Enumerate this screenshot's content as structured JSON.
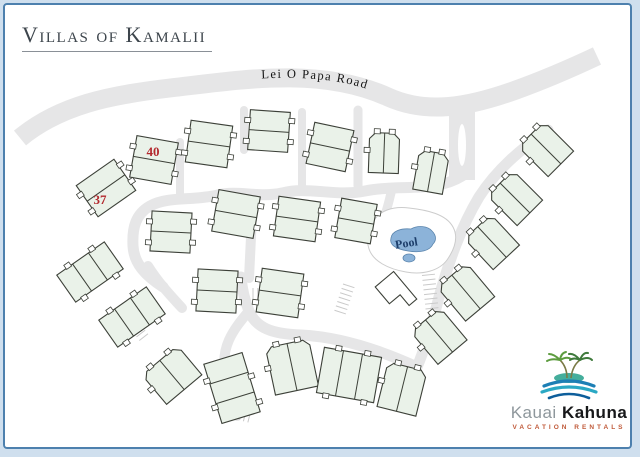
{
  "title": {
    "text": "Villas of Kamalii"
  },
  "logo": {
    "word1": "Kauai",
    "word2": "Kahuna",
    "tagline": "Vacation Rentals",
    "colors": {
      "word1": "#8e979c",
      "word2": "#17181a",
      "tagline": "#c05a3a",
      "palm": "#5d9c3f",
      "palm_dark": "#3f7a3c",
      "island": "#45ae9c",
      "wave1": "#1d7fb5",
      "wave2": "#2aa8c4",
      "wave3": "#0d5e9b"
    }
  },
  "frame": {
    "outer_band": "#cfdfee",
    "line": "#4d80ae",
    "background": "#ffffff"
  },
  "map": {
    "road_label": "Lei O Papa Road",
    "pool_label": "Pool",
    "unit_labels": [
      {
        "text": "40",
        "x": 153,
        "y": 156
      },
      {
        "text": "37",
        "x": 100,
        "y": 204
      }
    ],
    "colors": {
      "road": "#e6e6e7",
      "comb": "#c9c9c9",
      "building_fill": "#eaf2e9",
      "building_stroke": "#3c4038",
      "deck_stroke": "#cccccc",
      "pool_water": "#8cb3d9",
      "pool_stroke": "#5b85ad",
      "pool_text": "#1d3e6b",
      "label_red": "#b3282d",
      "road_text": "#151515"
    },
    "roads": {
      "main": "M 20,138 C 60,105 110,95 170,88 C 240,80 320,66 388,97 C 426,114 466,108 516,90 C 552,77 580,64 597,56",
      "main_width": 19,
      "entrance": {
        "d": "M 462,102 L 462,180",
        "width": 26,
        "median": {
          "cx": 462,
          "cy": 145,
          "rx": 4,
          "ry": 21
        }
      },
      "internal": [
        {
          "d": "M 462,176 C 435,193 400,184 365,191 C 335,197 308,186 282,193 C 258,198 238,190 218,195 C 193,201 168,196 150,206 C 136,214 132,227 133,246 C 134,264 146,276 163,287",
          "w": 11
        },
        {
          "d": "M 548,130 C 521,149 497,169 479,197 C 461,227 449,261 439,297 C 431,328 424,351 417,367",
          "w": 11
        },
        {
          "d": "M 417,367 C 382,351 341,337 301,335 C 272,334 256,328 249,311 C 244,299 242,288 241,277",
          "w": 11
        },
        {
          "d": "M 253,196 L 249,278",
          "w": 10
        },
        {
          "d": "M 249,311 C 233,330 219,348 226,377 C 230,396 234,408 237,416",
          "w": 10
        },
        {
          "d": "M 358,110 L 358,186",
          "w": 9
        },
        {
          "d": "M 302,112 L 302,188",
          "w": 8
        },
        {
          "d": "M 244,110 L 244,150",
          "w": 8
        },
        {
          "d": "M 180,142 L 180,198",
          "w": 8
        },
        {
          "d": "M 392,188 C 389,204 385,214 382,226",
          "w": 9
        },
        {
          "d": "M 148,266 C 158,282 170,295 182,308",
          "w": 10
        }
      ]
    },
    "parking": [
      {
        "x": 381,
        "y": 220,
        "rot": 0,
        "n": 8,
        "gap": 4.6,
        "len": 12,
        "dir": "h"
      },
      {
        "x": 421,
        "y": 266,
        "rot": -6,
        "n": 10,
        "gap": 4.8,
        "len": 13,
        "dir": "h"
      },
      {
        "x": 253,
        "y": 288,
        "rot": 0,
        "n": 7,
        "gap": 4.8,
        "len": 12,
        "dir": "v"
      },
      {
        "x": 224,
        "y": 404,
        "rot": 14,
        "n": 7,
        "gap": 4.6,
        "len": 12,
        "dir": "v"
      },
      {
        "x": 343,
        "y": 284,
        "rot": 18,
        "n": 7,
        "gap": 4.6,
        "len": 12,
        "dir": "h"
      },
      {
        "x": 128,
        "y": 326,
        "rot": -38,
        "n": 5,
        "gap": 4.6,
        "len": 11,
        "dir": "h"
      }
    ],
    "pool": {
      "deck_d": "M 372,224 C 378,210 394,206 409,208 C 427,210 446,214 453,227 C 459,238 454,250 447,260 C 439,271 422,275 406,272 C 388,269 373,261 369,249 C 366,240 368,231 372,224 Z",
      "water_d": "M 391,238 C 392,231 401,228 411,229 C 418,225 428,226 432,231 C 437,236 436,241 433,244 C 430,251 420,253 408,251 C 396,249 389,245 391,238 Z",
      "spa": {
        "cx": 409,
        "cy": 258,
        "rx": 6,
        "ry": 4
      },
      "label_x": 407,
      "label_y": 247,
      "label_rot": -9
    },
    "clubhouse": {
      "x": 396,
      "y": 293,
      "rot": -40,
      "d": "M -12,-18 L 12,-18 L 12,18 L 2,18 L 2,4 L -12,4 Z"
    },
    "buildings": [
      {
        "x": 154,
        "y": 160,
        "rot": 10,
        "t": "duplex",
        "w": 42,
        "h": 42
      },
      {
        "x": 106,
        "y": 188,
        "rot": -35,
        "t": "duplex",
        "w": 46,
        "h": 38
      },
      {
        "x": 209,
        "y": 144,
        "rot": 8,
        "t": "duplex",
        "w": 42,
        "h": 42
      },
      {
        "x": 269,
        "y": 131,
        "rot": 4,
        "t": "duplex",
        "w": 40,
        "h": 40
      },
      {
        "x": 330,
        "y": 147,
        "rot": 12,
        "t": "duplex",
        "w": 40,
        "h": 42
      },
      {
        "x": 384,
        "y": 153,
        "rot": 2,
        "t": "pair",
        "w": 30,
        "h": 40
      },
      {
        "x": 431,
        "y": 172,
        "rot": 10,
        "t": "pair",
        "w": 30,
        "h": 40
      },
      {
        "x": 171,
        "y": 232,
        "rot": 3,
        "t": "duplex",
        "w": 40,
        "h": 40
      },
      {
        "x": 236,
        "y": 214,
        "rot": 10,
        "t": "duplex",
        "w": 42,
        "h": 42
      },
      {
        "x": 297,
        "y": 219,
        "rot": 8,
        "t": "duplex",
        "w": 42,
        "h": 40
      },
      {
        "x": 356,
        "y": 221,
        "rot": 10,
        "t": "duplex",
        "w": 36,
        "h": 40
      },
      {
        "x": 90,
        "y": 272,
        "rot": -35,
        "t": "tri",
        "w": 58,
        "h": 33
      },
      {
        "x": 132,
        "y": 317,
        "rot": -35,
        "t": "tri",
        "w": 58,
        "h": 33
      },
      {
        "x": 172,
        "y": 375,
        "rot": -40,
        "t": "pair",
        "w": 46,
        "h": 38
      },
      {
        "x": 217,
        "y": 291,
        "rot": 3,
        "t": "duplex",
        "w": 40,
        "h": 42
      },
      {
        "x": 280,
        "y": 293,
        "rot": 8,
        "t": "duplex",
        "w": 42,
        "h": 44
      },
      {
        "x": 232,
        "y": 388,
        "rot": -17,
        "t": "tristack",
        "w": 40,
        "h": 62
      },
      {
        "x": 292,
        "y": 367,
        "rot": -12,
        "t": "pair",
        "w": 44,
        "h": 48
      },
      {
        "x": 349,
        "y": 375,
        "rot": 10,
        "t": "tri",
        "w": 58,
        "h": 46
      },
      {
        "x": 402,
        "y": 389,
        "rot": 14,
        "t": "pair",
        "w": 40,
        "h": 46
      },
      {
        "x": 546,
        "y": 149,
        "rot": -45,
        "t": "pair",
        "w": 36,
        "h": 42
      },
      {
        "x": 515,
        "y": 198,
        "rot": -45,
        "t": "pair",
        "w": 36,
        "h": 42
      },
      {
        "x": 492,
        "y": 242,
        "rot": -43,
        "t": "pair",
        "w": 36,
        "h": 42
      },
      {
        "x": 466,
        "y": 292,
        "rot": -40,
        "t": "pair",
        "w": 38,
        "h": 44
      },
      {
        "x": 439,
        "y": 336,
        "rot": -40,
        "t": "pair",
        "w": 38,
        "h": 42
      }
    ]
  }
}
